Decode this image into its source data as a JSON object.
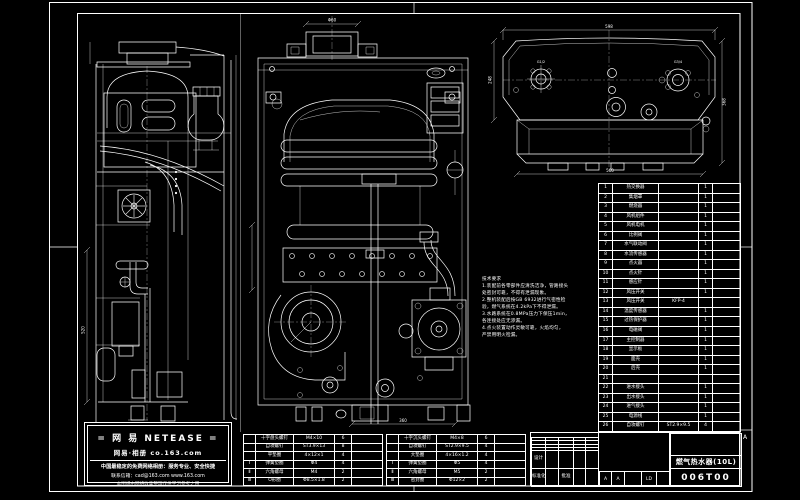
{
  "colors": {
    "background": "#000000",
    "line": "#ffffff"
  },
  "watermark": {
    "line1": "= 网 易  NETEASE =",
    "line2": "网易·相册  co.163.com",
    "line3": "中国最稳定的免费网络相册：服务专业、安全快捷",
    "line4": "联系信箱：cad@163.com  www.163.com",
    "line5": "本图纸由网络收集整理仅供学习参考之用"
  },
  "title_block": {
    "title": "燃气热水器(10L)",
    "drawing_no": "006T00",
    "zone_marker": "A",
    "middle_marks": {
      "mark1": "A",
      "mark2": "A",
      "code": "LD"
    },
    "left_grid_rows": [
      [
        "",
        "",
        "",
        "",
        ""
      ],
      [
        "",
        "",
        "",
        "",
        ""
      ],
      [
        "",
        "",
        "",
        "",
        ""
      ],
      [
        "",
        "",
        "",
        "",
        ""
      ],
      [
        "设计",
        "",
        "",
        "",
        ""
      ],
      [
        "标准化",
        "",
        "批准",
        "",
        ""
      ]
    ]
  },
  "notes": {
    "lines": [
      "技术要求",
      "1.装配前各零部件应清洗洁净，管路接头",
      "  处密封可靠，不得有泄漏现象。",
      "2.整机装配后按GB 6932进行气密性检",
      "  验，燃气系统在4.2kPa下不得泄漏。",
      "3.水路系统在0.8MPa压力下保压1min，",
      "  各连接处应无渗漏。",
      "4.点火装置动作灵敏可靠，火焰均匀，",
      "  严禁用明火检漏。"
    ]
  },
  "bom": {
    "rows": [
      [
        "1",
        "热交换器",
        "",
        "1",
        ""
      ],
      [
        "2",
        "集烟罩",
        "",
        "1",
        ""
      ],
      [
        "3",
        "燃烧器",
        "",
        "1",
        ""
      ],
      [
        "4",
        "风机组件",
        "",
        "1",
        ""
      ],
      [
        "5",
        "风机电机",
        "",
        "1",
        ""
      ],
      [
        "6",
        "比例阀",
        "",
        "1",
        ""
      ],
      [
        "7",
        "水气联动阀",
        "",
        "1",
        ""
      ],
      [
        "8",
        "水流传感器",
        "",
        "1",
        ""
      ],
      [
        "9",
        "点火器",
        "",
        "1",
        ""
      ],
      [
        "10",
        "点火针",
        "",
        "1",
        ""
      ],
      [
        "11",
        "感应针",
        "",
        "1",
        ""
      ],
      [
        "12",
        "风压开关",
        "",
        "1",
        ""
      ],
      [
        "13",
        "风压开关",
        "KFP-4",
        "",
        ""
      ],
      [
        "14",
        "温度传感器",
        "",
        "1",
        ""
      ],
      [
        "15",
        "过热保护器",
        "",
        "1",
        ""
      ],
      [
        "16",
        "电磁阀",
        "",
        "1",
        ""
      ],
      [
        "17",
        "主控制器",
        "",
        "1",
        ""
      ],
      [
        "18",
        "显示板",
        "",
        "1",
        ""
      ],
      [
        "19",
        "面壳",
        "",
        "1",
        ""
      ],
      [
        "20",
        "后壳",
        "",
        "1",
        ""
      ],
      [
        "21",
        "",
        "",
        "",
        ""
      ],
      [
        "22",
        "进水接头",
        "",
        "1",
        ""
      ],
      [
        "23",
        "出水接头",
        "",
        "1",
        ""
      ],
      [
        "24",
        "进气接头",
        "",
        "1",
        ""
      ],
      [
        "25",
        "电源线",
        "",
        "1",
        ""
      ],
      [
        "26",
        "自攻螺钉",
        "ST2.9×9.5",
        "4",
        ""
      ]
    ]
  },
  "fastener_tables": {
    "left": {
      "rows": [
        [
          "",
          "十字盘头螺钉",
          "M4×10",
          "6",
          ""
        ],
        [
          "",
          "自攻螺钉",
          "ST3.9×13",
          "8",
          ""
        ],
        [
          "",
          "平垫圈",
          "4×12×1",
          "4",
          ""
        ],
        [
          "Ⅰ",
          "弹簧垫圈",
          "Φ4",
          "4",
          ""
        ],
        [
          "Ⅱ",
          "六角螺母",
          "M4",
          "2",
          ""
        ],
        [
          "Ⅲ",
          "O形圈",
          "Φ8.5×1.8",
          "2",
          ""
        ]
      ]
    },
    "right": {
      "rows": [
        [
          "",
          "十字沉头螺钉",
          "M4×8",
          "6",
          ""
        ],
        [
          "",
          "自攻螺钉",
          "ST2.9×9.5",
          "4",
          ""
        ],
        [
          "",
          "大垫圈",
          "4×16×1.2",
          "4",
          ""
        ],
        [
          "Ⅰ",
          "弹簧垫圈",
          "Φ5",
          "4",
          ""
        ],
        [
          "Ⅱ",
          "六角螺母",
          "M5",
          "2",
          ""
        ],
        [
          "Ⅲ",
          "密封圈",
          "Φ12×2",
          "2",
          ""
        ]
      ]
    }
  },
  "dimensions": {
    "flue_width": "Φ60",
    "top_width": "598",
    "left_height": "248",
    "right_height": "368",
    "bottom_width": "560",
    "middle_bottom": "360",
    "left_view_height": "520",
    "conn_left": "G1/2",
    "conn_right": "G3/4"
  }
}
